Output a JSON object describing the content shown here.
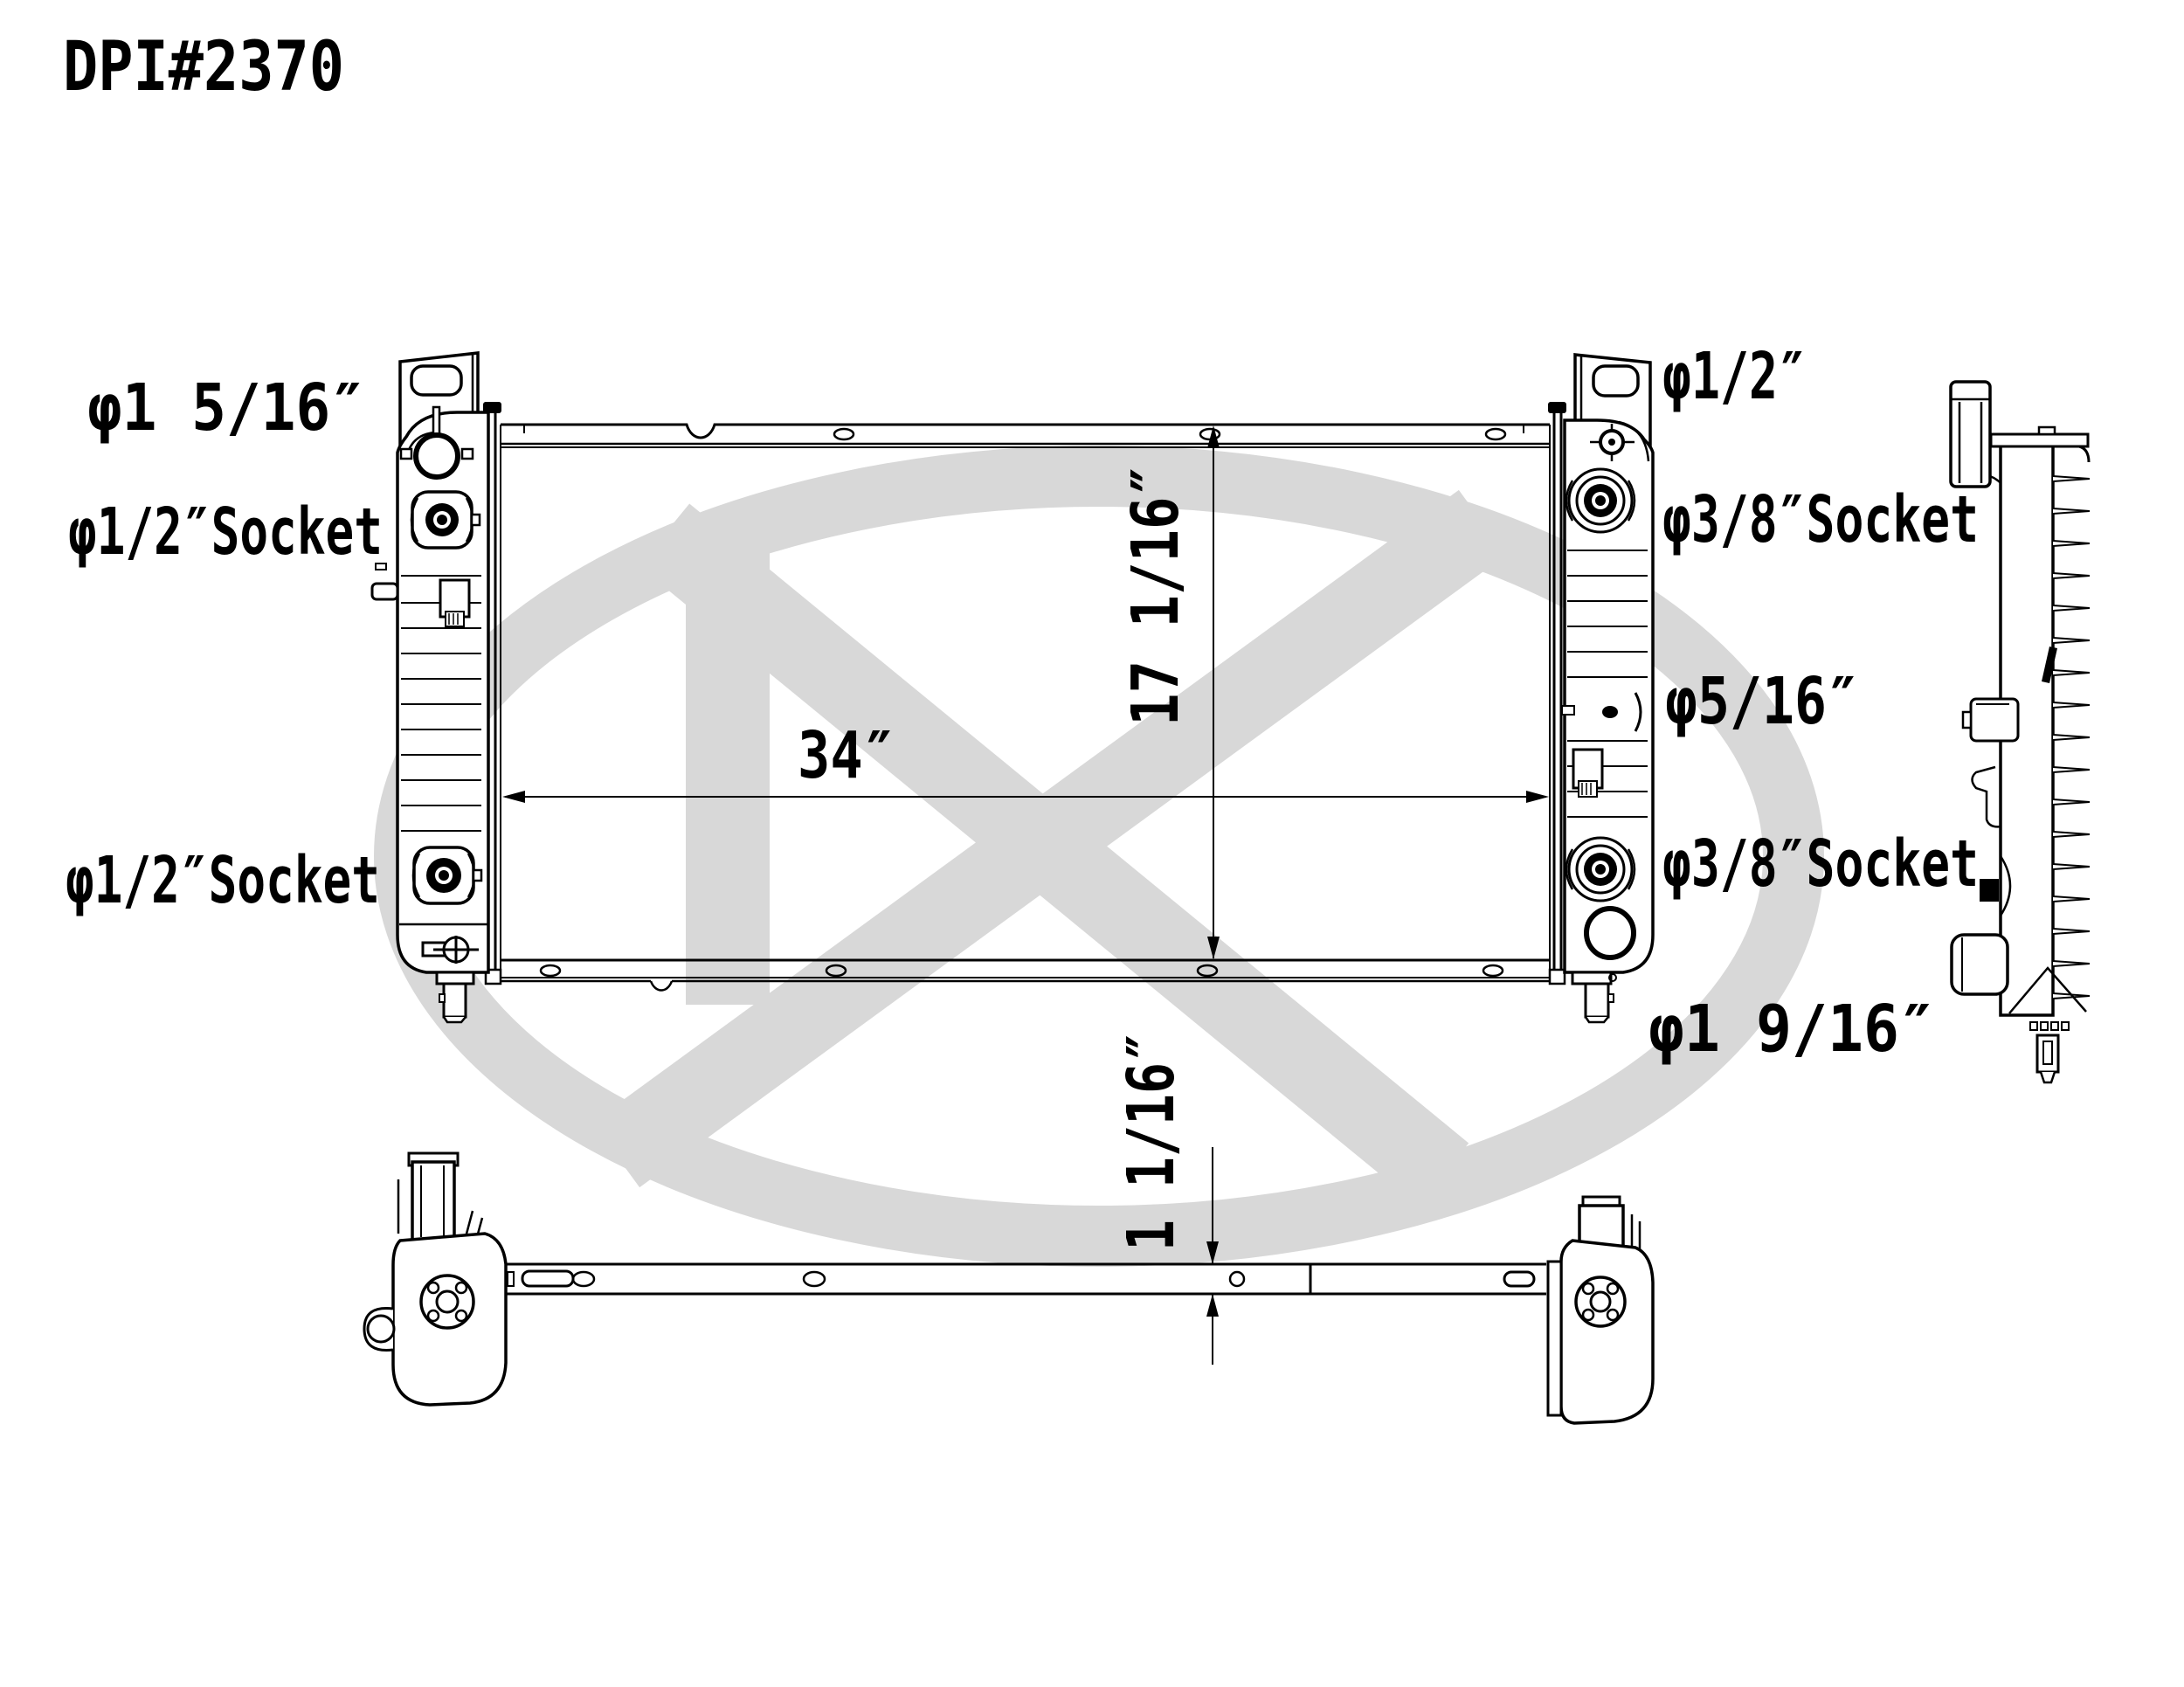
{
  "title": "DPI#2370",
  "colors": {
    "line": "#000000",
    "watermark": "#d8d8d8",
    "background": "#ffffff"
  },
  "labels": {
    "left": [
      {
        "text": "φ1 5/16″"
      },
      {
        "text": "φ1/2″Socket"
      },
      {
        "text": "φ1/2″Socket"
      }
    ],
    "right": [
      {
        "text": "φ1/2″"
      },
      {
        "text": "φ3/8″Socket"
      },
      {
        "text": "φ5/16″"
      },
      {
        "text": "φ3/8″Socket"
      },
      {
        "text": "φ1 9/16″"
      }
    ]
  },
  "dimensions": {
    "core_width": "34″",
    "core_height": "17 1/16″",
    "core_thickness": "1 1/16″"
  }
}
